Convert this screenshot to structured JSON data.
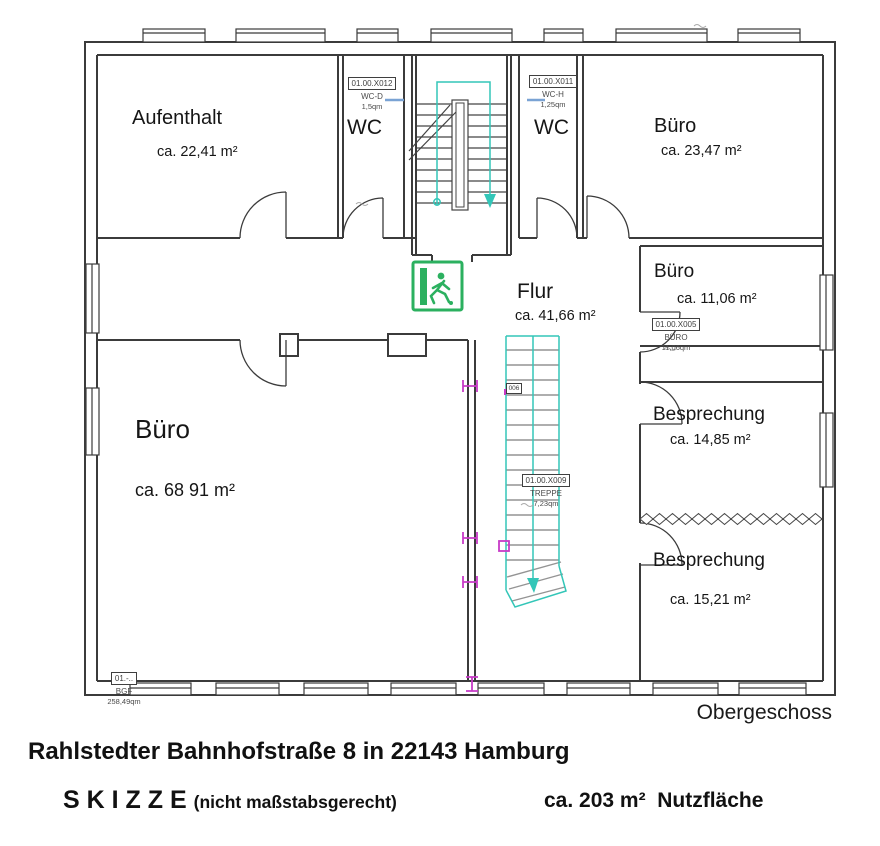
{
  "rooms": {
    "aufenthalt": {
      "name": "Aufenthalt",
      "area": "ca. 22,41 m²"
    },
    "wc_left": {
      "name": "WC"
    },
    "wc_right": {
      "name": "WC"
    },
    "buero_top": {
      "name": "Büro",
      "area": "ca. 23,47 m²"
    },
    "buero_mid": {
      "name": "Büro",
      "area": "ca. 11,06 m²"
    },
    "flur": {
      "name": "Flur",
      "area": "ca. 41,66 m²"
    },
    "buero_main": {
      "name": "Büro",
      "area": "ca. 68 91 m²"
    },
    "besprechung1": {
      "name": "Besprechung",
      "area": "ca. 14,85 m²"
    },
    "besprechung2": {
      "name": "Besprechung",
      "area": "ca. 15,21 m²"
    }
  },
  "tags": {
    "wc_d": {
      "code": "01.00.X012",
      "name": "WC-D",
      "area": "1,5qm"
    },
    "wc_h": {
      "code": "01.00.X011",
      "name": "WC-H",
      "area": "1,25qm"
    },
    "buero": {
      "code": "01.00.X005",
      "name": "BÜRO",
      "area": "11,06qm"
    },
    "treppe": {
      "code": "01.00.X009",
      "name": "TREPPE",
      "area": "7,23qm"
    },
    "flur_mini": {
      "code": "006"
    },
    "bgf": {
      "code": "01.-..",
      "name": "BGF",
      "area": "258,49qm"
    }
  },
  "footer": {
    "floor_label": "Obergeschoss",
    "address": "Rahlstedter Bahnhofstraße 8 in 22143 Hamburg",
    "sketch_title": "S K I Z Z E",
    "sketch_note": "(nicht maßstabsgerecht)",
    "total_area": "ca. 203 m²  Nutzfläche"
  },
  "colors": {
    "wall": "#3b3b3b",
    "stair": "#33c6b8",
    "step": "#949494",
    "exit_green": "#2bb05f",
    "marker": "#c73bc7",
    "glass": "#7aa3d4"
  }
}
